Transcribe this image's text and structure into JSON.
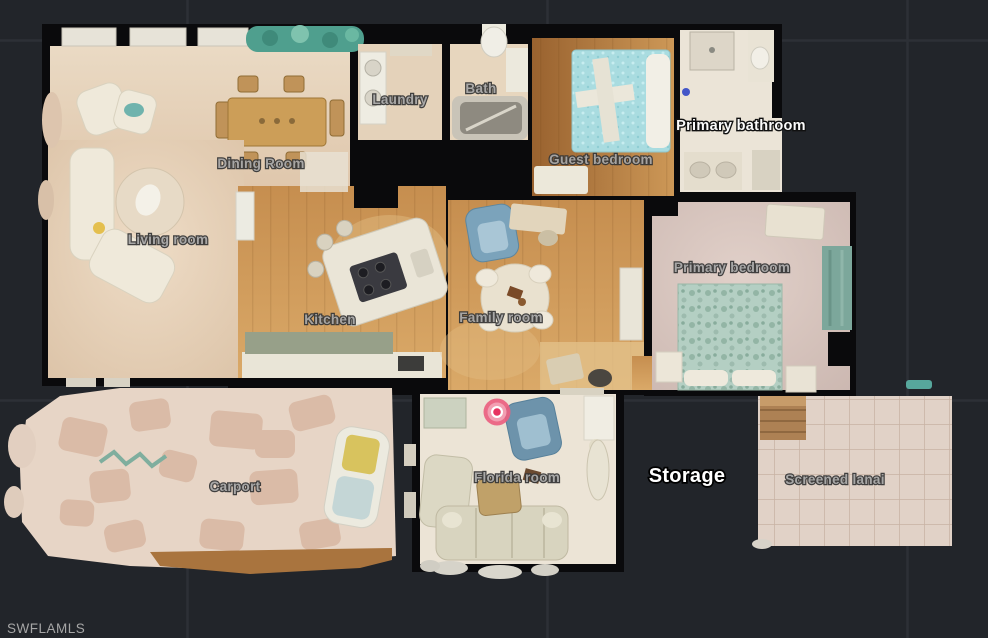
{
  "app": {
    "type": "floorplan-viewer",
    "background_color": "#22252a",
    "grid_color": "#2d3036",
    "wall_color": "#0a0a0c"
  },
  "watermark": "SWFLAMLS",
  "marker": {
    "name": "current-position-marker",
    "color_outer": "#ea5f80",
    "color_center": "#e73360",
    "x": 497,
    "y": 412
  },
  "rooms": [
    {
      "id": "laundry",
      "label": "Laundry",
      "style": "dim"
    },
    {
      "id": "bath",
      "label": "Bath",
      "style": "dim"
    },
    {
      "id": "guest-bedroom",
      "label": "Guest bedroom",
      "style": "dim"
    },
    {
      "id": "primary-bathroom",
      "label": "Primary bathroom",
      "style": "bright"
    },
    {
      "id": "dining-room",
      "label": "Dining Room",
      "style": "dim"
    },
    {
      "id": "living-room",
      "label": "Living room",
      "style": "dim"
    },
    {
      "id": "kitchen",
      "label": "Kitchen",
      "style": "dim"
    },
    {
      "id": "family-room",
      "label": "Family room",
      "style": "dim"
    },
    {
      "id": "primary-bedroom",
      "label": "Primary bedroom",
      "style": "dim"
    },
    {
      "id": "carport",
      "label": "Carport",
      "style": "dim"
    },
    {
      "id": "florida-room",
      "label": "Florida room",
      "style": "dim"
    },
    {
      "id": "storage",
      "label": "Storage",
      "style": "storage"
    },
    {
      "id": "screened-lanai",
      "label": "Screened lanai",
      "style": "dim"
    }
  ]
}
